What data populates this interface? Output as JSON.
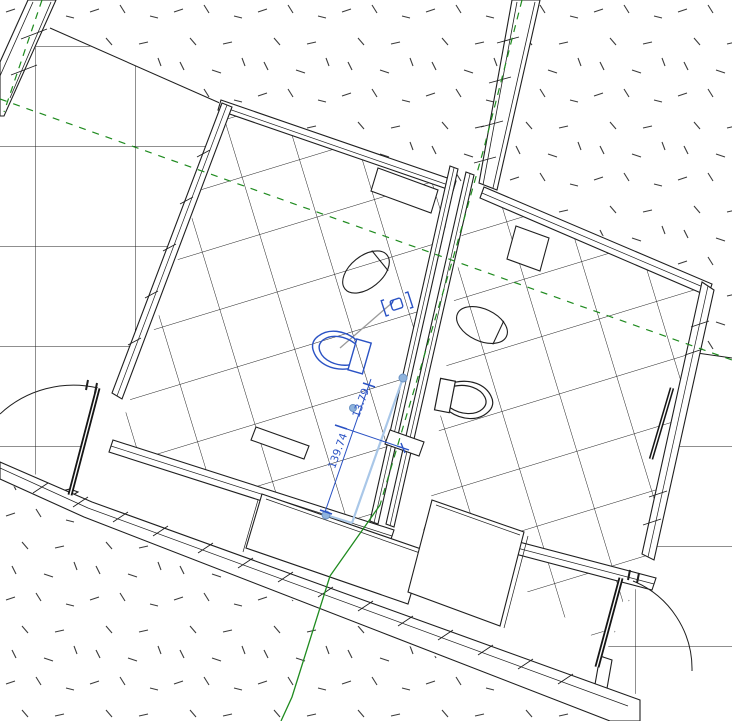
{
  "view": {
    "type": "cad-plan-view"
  },
  "selection": {
    "dim_small": "13.79",
    "dim_large": "139.74"
  },
  "colors": {
    "selection_blue": "#2a52c4",
    "highlight_blue": "#a9c7e8",
    "handle_fill": "#8fb3dc",
    "reference_green": "#1f8b1f",
    "drawing_black": "#1f1f1f",
    "leader_gray": "#9a9a9a"
  }
}
